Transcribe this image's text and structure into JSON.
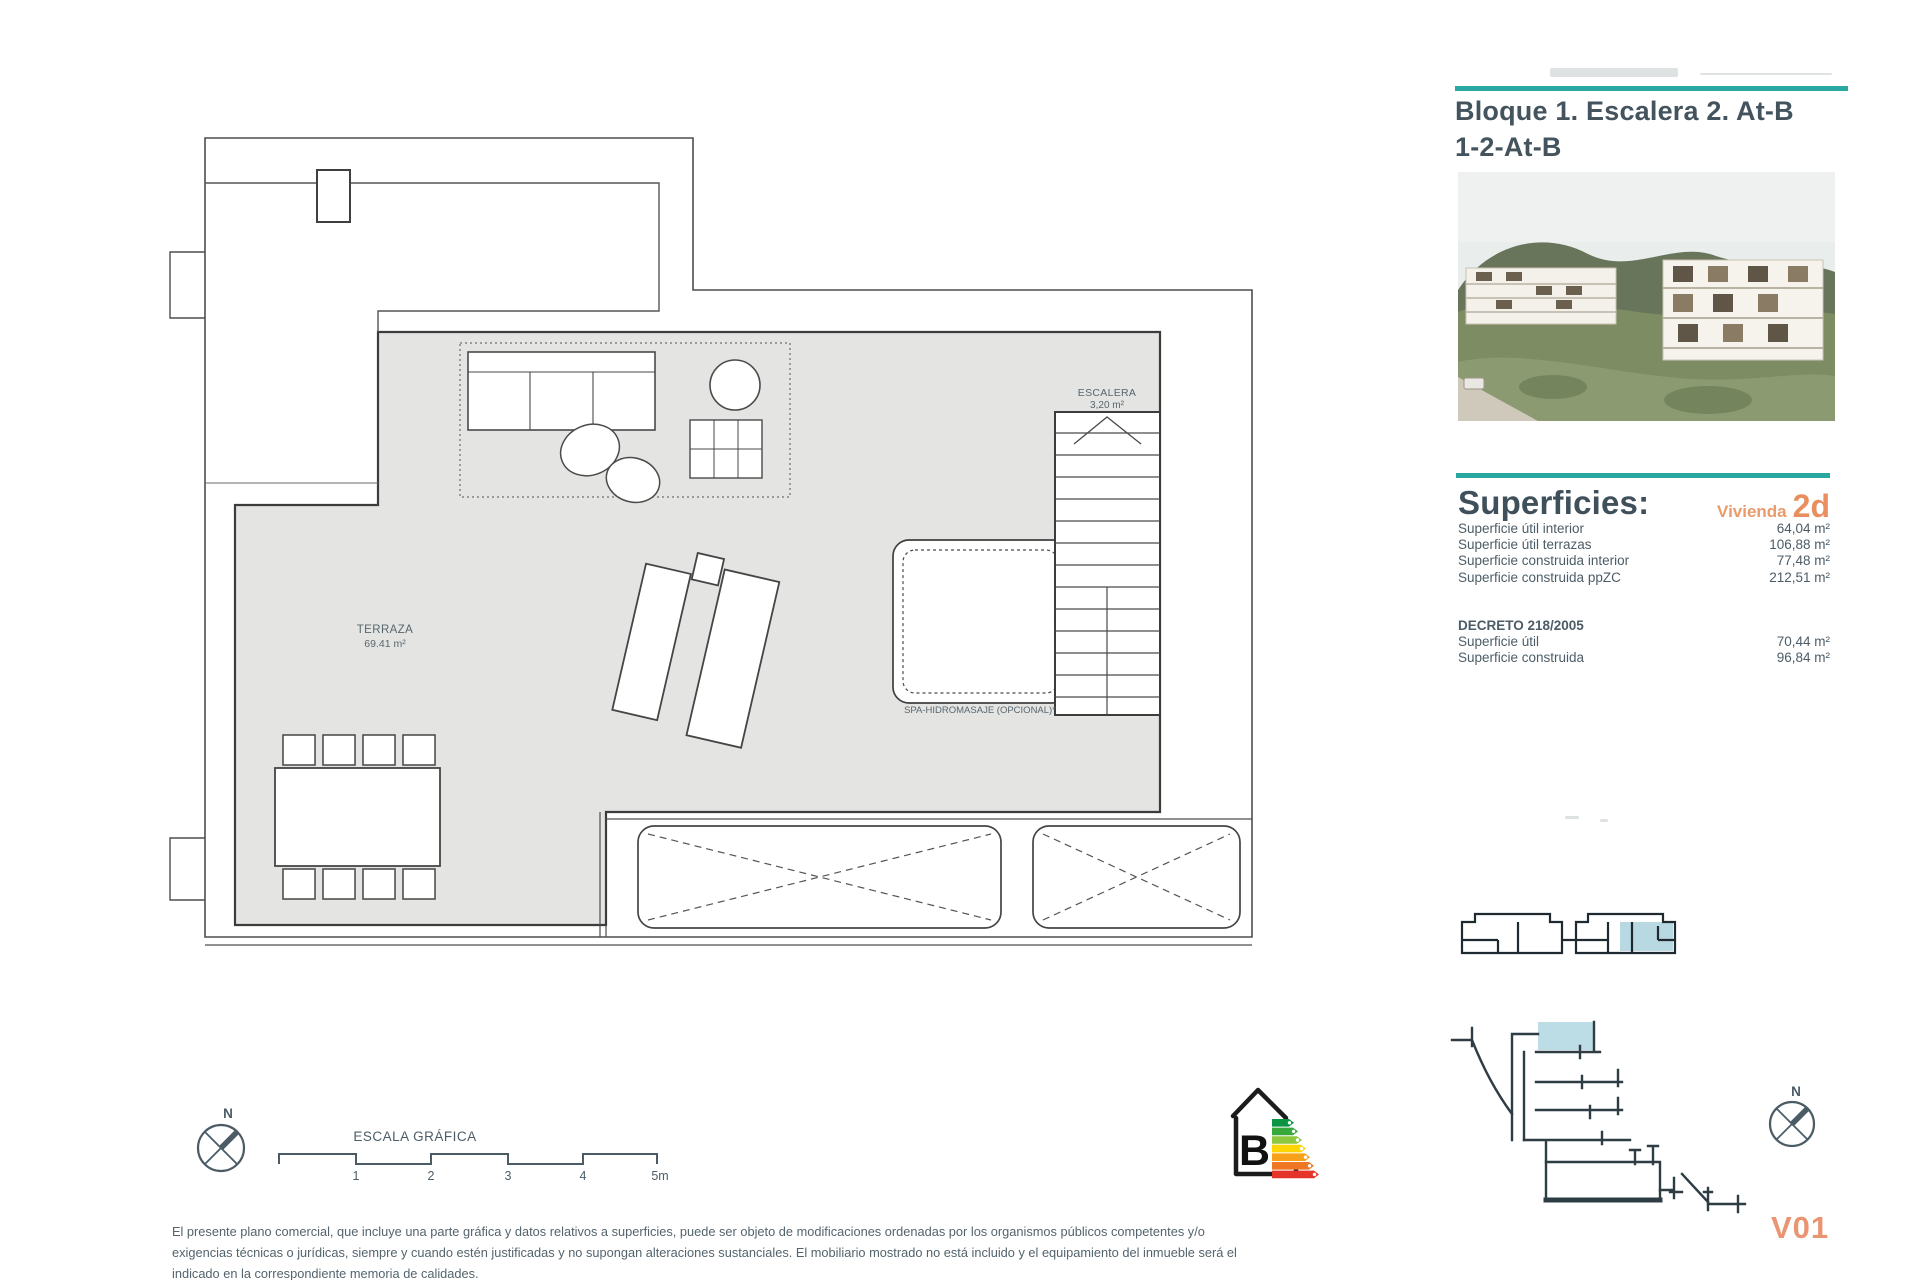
{
  "accent_teal": "#29a7a1",
  "accent_orange": "#e98f5f",
  "title_block": {
    "line1": "Bloque 1. Escalera 2. At-B",
    "line2": "1-2-At-B"
  },
  "superficies": {
    "heading": "Superficies:",
    "vivienda_label": "Vivienda",
    "vivienda_code": "2d",
    "rows": [
      {
        "label": "Superficie útil interior",
        "value": "64,04 m²"
      },
      {
        "label": "Superficie útil terrazas",
        "value": "106,88 m²"
      },
      {
        "label": "Superficie construida interior",
        "value": "77,48 m²"
      },
      {
        "label": "Superficie construida ppZC",
        "value": "212,51 m²"
      }
    ],
    "decreto_heading": "DECRETO 218/2005",
    "decreto_rows": [
      {
        "label": "Superficie útil",
        "value": "70,44 m²"
      },
      {
        "label": "Superficie construida",
        "value": "96,84 m²"
      }
    ]
  },
  "plan": {
    "terraza_label": "TERRAZA",
    "terraza_area": "69.41 m²",
    "escalera_label": "ESCALERA",
    "escalera_area": "3,20 m²",
    "spa_label": "SPA-HIDROMASAJE (OPCIONAL)*"
  },
  "scale_bar": {
    "title": "ESCALA GRÁFICA",
    "ticks": [
      "1",
      "2",
      "3",
      "4",
      "5m"
    ]
  },
  "north_label": "N",
  "energy": {
    "letter": "B",
    "bar_colors": [
      "#0b9444",
      "#37a83a",
      "#8dc63f",
      "#ffd500",
      "#f7a11a",
      "#ef7622",
      "#e5342a"
    ]
  },
  "version": "V01",
  "disclaimer": "El presente plano comercial, que incluye una parte gráfica y datos relativos a superficies, puede ser objeto de modificaciones ordenadas por los organismos públicos competentes y/o exigencias técnicas o jurídicas, siempre y cuando estén justificadas y no supongan alteraciones sustanciales. El mobiliario mostrado no está incluido y el equipamiento del inmueble será el indicado en la correspondiente memoria de calidades."
}
